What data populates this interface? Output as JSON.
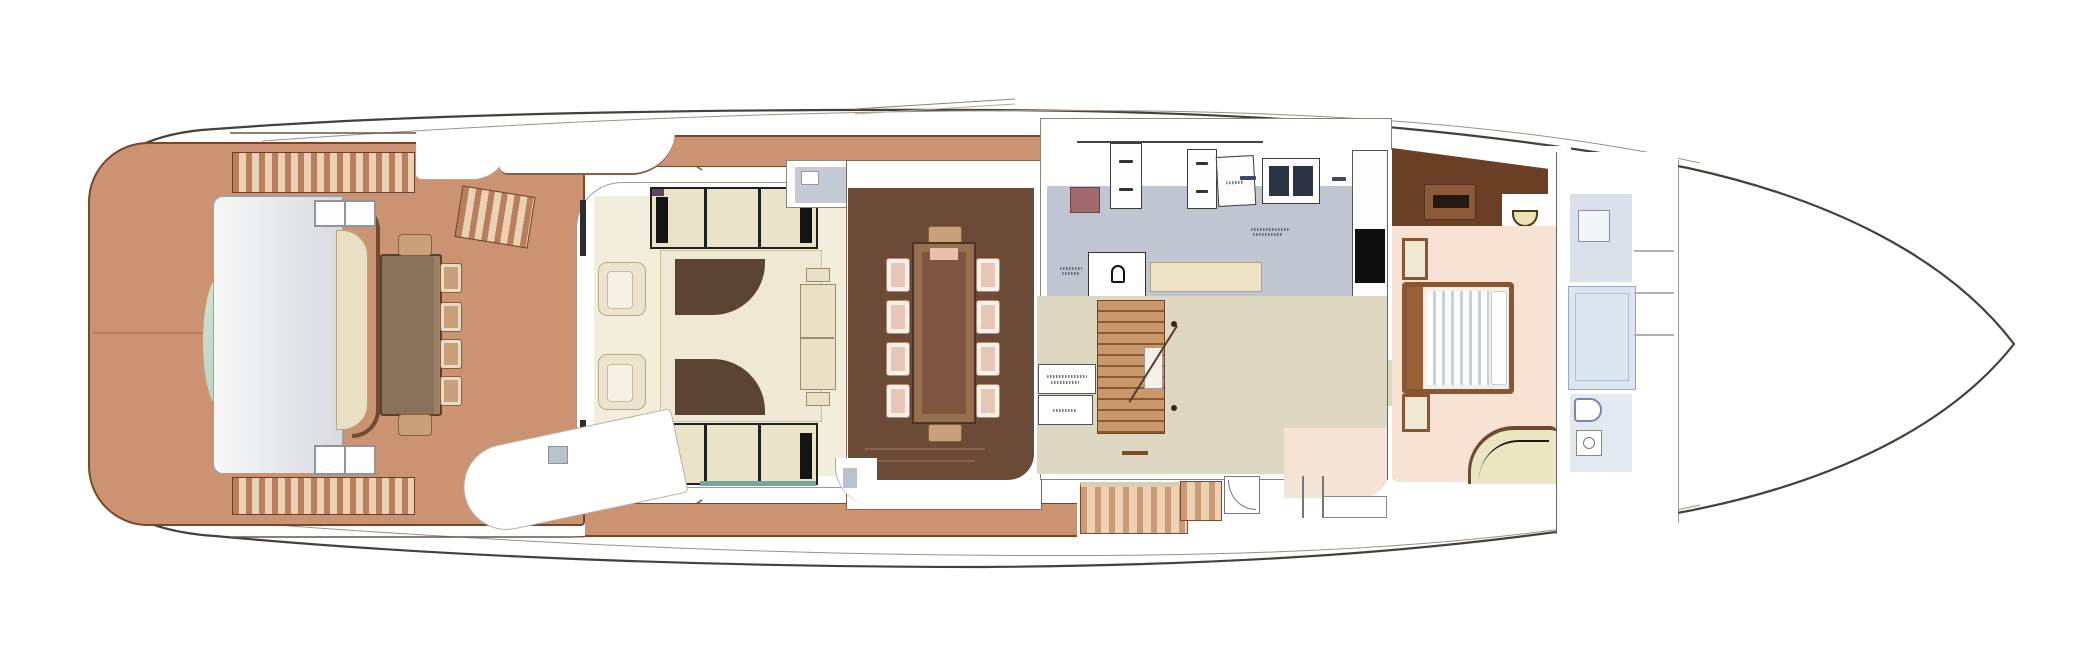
{
  "canvas": {
    "width": 2097,
    "height": 672,
    "background": "#ffffff",
    "content": "yacht-main-deck-floor-plan-top-view"
  },
  "visible_text": [],
  "illegible_text_marks": 7,
  "palette": {
    "hull_line": "#45403a",
    "deck_teak": "#cb9372",
    "deck_edge": "#7c4527",
    "step_dark": "#b97f5c",
    "step_light": "#ecd0b4",
    "salon_floor": "#f3eddc",
    "sofa_cream": "#efe8d4",
    "sofa_shadow": "#5c4433",
    "window_frame": "#1f1f1f",
    "window_pane": "#eae2c9",
    "teal_accent": "#6fa8a0",
    "dining_floor": "#6b4a37",
    "table_wood": "#7d5740",
    "chair_blush": "#e8c6b6",
    "galley_floor": "#bfc5d1",
    "cabinet_white": "#fdfdfd",
    "tv_black": "#0d0d0d",
    "mauve_counter": "#a06a6e",
    "corridor_beige": "#ded8c2",
    "stair_wood": "#c9996b",
    "foyer_peach": "#f5e3d6",
    "master_floor": "#f7e2d4",
    "bed_frame": "#8a5632",
    "duvet_stripe": "#c7d1dc",
    "vanity_brown": "#6b3f26",
    "settee_cream": "#ece5c2",
    "bath_floor": "#dce6f0",
    "transom_silver": "#d8dbe0",
    "transom_green": "#cfe2d4"
  },
  "regions": [
    {
      "name": "hull"
    },
    {
      "name": "bow-deck"
    },
    {
      "name": "aft-deck"
    },
    {
      "name": "transom-seating"
    },
    {
      "name": "aft-deck-dining-table"
    },
    {
      "name": "deck-steps"
    },
    {
      "name": "salon"
    },
    {
      "name": "salon-sofa"
    },
    {
      "name": "armchair"
    },
    {
      "name": "sideboard"
    },
    {
      "name": "salon-window"
    },
    {
      "name": "dining-room"
    },
    {
      "name": "dining-table"
    },
    {
      "name": "side-boarding-platform"
    },
    {
      "name": "galley"
    },
    {
      "name": "galley-cabinets"
    },
    {
      "name": "helm-console"
    },
    {
      "name": "day-head-wc"
    },
    {
      "name": "staircase"
    },
    {
      "name": "corridor"
    },
    {
      "name": "master-cabin"
    },
    {
      "name": "vanity"
    },
    {
      "name": "master-bed"
    },
    {
      "name": "master-settee"
    },
    {
      "name": "master-bathroom"
    },
    {
      "name": "shower"
    },
    {
      "name": "wc"
    },
    {
      "name": "washbasin"
    }
  ]
}
